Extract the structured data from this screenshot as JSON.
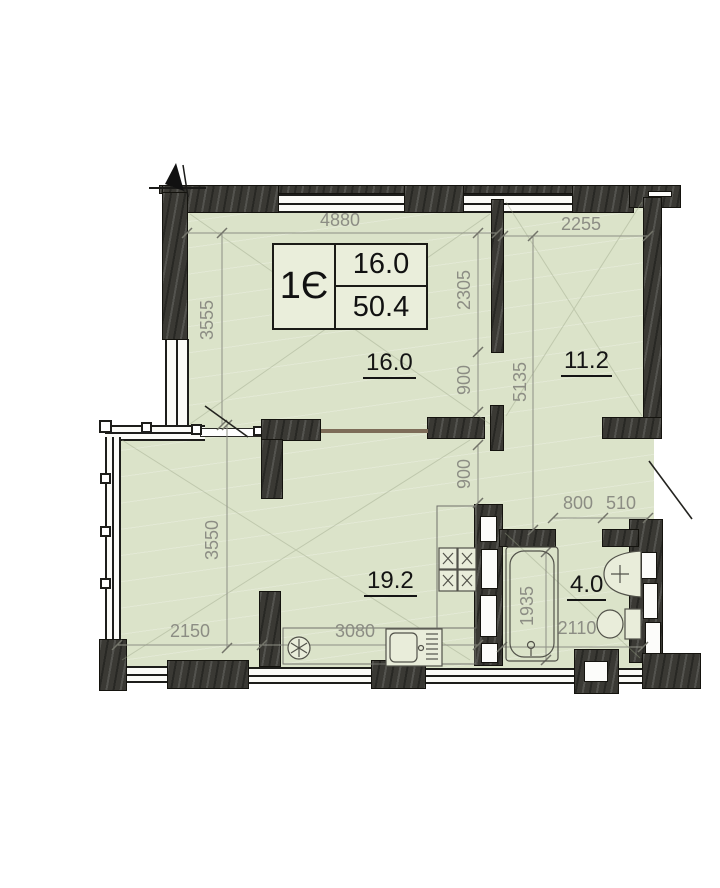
{
  "info_box": {
    "unit_type": "1Є",
    "upper_value": "16.0",
    "lower_value": "50.4"
  },
  "rooms": [
    {
      "name": "living-room",
      "area": "16.0"
    },
    {
      "name": "bedroom",
      "area": "11.2"
    },
    {
      "name": "kitchen-living-room",
      "area": "19.2"
    },
    {
      "name": "bathroom",
      "area": "4.0"
    }
  ],
  "dimensions": {
    "living_width": "4880",
    "bedroom_width": "2255",
    "living_height": "3555",
    "partition_upper": "2305",
    "opening_upper": "900",
    "hall_height": "5135",
    "opening_lower": "900",
    "kitchen_height": "3550",
    "balcony_width": "2150",
    "kitchen_width": "3080",
    "bath_door_width": "800",
    "bath_niche_width": "510",
    "bathroom_width": "2110",
    "bathtub_length": "1935"
  },
  "colors": {
    "floor": "#dbe3c9",
    "wall": "#3a3934",
    "dimension_text": "#8c8d84",
    "room_label": "#141414"
  },
  "icons": {
    "north_arrow": "north-arrow-icon",
    "fridge": "fridge-icon",
    "stove": "stove-icon",
    "kitchen_sink": "kitchen-sink-icon",
    "bathtub": "bathtub-icon",
    "washbasin": "washbasin-icon",
    "toilet": "toilet-icon"
  }
}
